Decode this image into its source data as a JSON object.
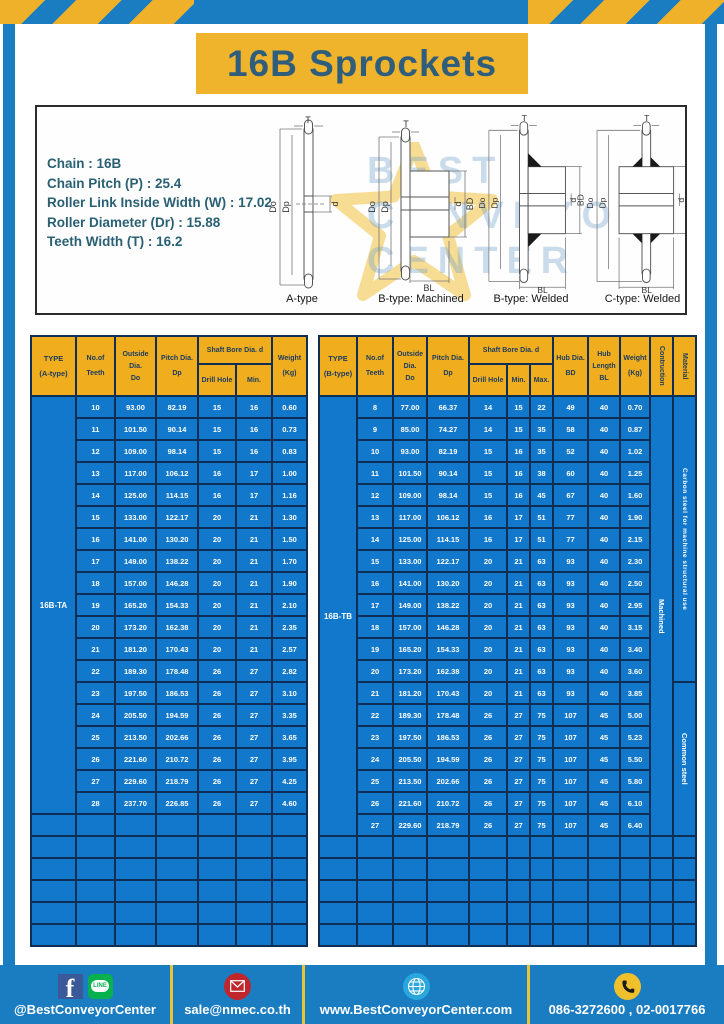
{
  "title": "16B Sprockets",
  "specs": {
    "lines": [
      "Chain  :  16B",
      "Chain Pitch (P)  :  25.4",
      "Roller Link Inside Width (W)  :  17.02",
      "Roller Diameter (Dr)  : 15.88",
      "Teeth Width (T)  :  16.2"
    ]
  },
  "diagrams": {
    "captions": [
      "A-type",
      "B-type: Machined",
      "B-type: Welded",
      "C-type: Welded"
    ],
    "dims": {
      "T": "T",
      "Do": "Do",
      "Dp": "Dp",
      "d": "d",
      "BD": "BD",
      "BL": "BL"
    },
    "watermark": [
      "BEST",
      "CONVEYOR",
      "CENTER"
    ]
  },
  "table_a": {
    "headers": {
      "type1": "TYPE",
      "type2": "(A-type)",
      "teeth1": "No.of",
      "teeth2": "Teeth",
      "outside1": "Outside",
      "outside2": "Dia.",
      "outside3": "Do",
      "pitch1": "Pitch Dia.",
      "pitch2": "Dp",
      "shaft": "Shaft Bore Dia. d",
      "drill": "Drill Hole",
      "min": "Min.",
      "weight1": "Weight",
      "weight2": "(Kg)"
    },
    "type_value": "16B-TA",
    "rows": [
      [
        "10",
        "93.00",
        "82.19",
        "15",
        "16",
        "0.60"
      ],
      [
        "11",
        "101.50",
        "90.14",
        "15",
        "16",
        "0.73"
      ],
      [
        "12",
        "109.00",
        "98.14",
        "15",
        "16",
        "0.83"
      ],
      [
        "13",
        "117.00",
        "106.12",
        "16",
        "17",
        "1.00"
      ],
      [
        "14",
        "125.00",
        "114.15",
        "16",
        "17",
        "1.16"
      ],
      [
        "15",
        "133.00",
        "122.17",
        "20",
        "21",
        "1.30"
      ],
      [
        "16",
        "141.00",
        "130.20",
        "20",
        "21",
        "1.50"
      ],
      [
        "17",
        "149.00",
        "138.22",
        "20",
        "21",
        "1.70"
      ],
      [
        "18",
        "157.00",
        "146.28",
        "20",
        "21",
        "1.90"
      ],
      [
        "19",
        "165.20",
        "154.33",
        "20",
        "21",
        "2.10"
      ],
      [
        "20",
        "173.20",
        "162.38",
        "20",
        "21",
        "2.35"
      ],
      [
        "21",
        "181.20",
        "170.43",
        "20",
        "21",
        "2.57"
      ],
      [
        "22",
        "189.30",
        "178.48",
        "26",
        "27",
        "2.82"
      ],
      [
        "23",
        "197.50",
        "186.53",
        "26",
        "27",
        "3.10"
      ],
      [
        "24",
        "205.50",
        "194.59",
        "26",
        "27",
        "3.35"
      ],
      [
        "25",
        "213.50",
        "202.66",
        "26",
        "27",
        "3.65"
      ],
      [
        "26",
        "221.60",
        "210.72",
        "26",
        "27",
        "3.95"
      ],
      [
        "27",
        "229.60",
        "218.79",
        "26",
        "27",
        "4.25"
      ],
      [
        "28",
        "237.70",
        "226.85",
        "26",
        "27",
        "4.60"
      ]
    ],
    "empty_rows": 6
  },
  "table_b": {
    "headers": {
      "type1": "TYPE",
      "type2": "(B-type)",
      "teeth1": "No.of",
      "teeth2": "Teeth",
      "outside1": "Outside",
      "outside2": "Dia.",
      "outside3": "Do",
      "pitch1": "Pitch Dia.",
      "pitch2": "Dp",
      "shaft": "Shaft Bore Dia. d",
      "drill": "Drill Hole",
      "min": "Min.",
      "max": "Max.",
      "hub1": "Hub Dia.",
      "hub2": "BD",
      "hublen1": "Hub",
      "hublen2": "Length",
      "hublen3": "BL",
      "weight1": "Weight",
      "weight2": "(Kg)",
      "construction": "Contruction",
      "material": "Material"
    },
    "type_value": "16B-TB",
    "construction_value": "Machined",
    "materials": [
      "Carbon steel for machine structural use",
      "Common steel"
    ],
    "rows": [
      [
        "8",
        "77.00",
        "66.37",
        "14",
        "15",
        "22",
        "49",
        "40",
        "0.70"
      ],
      [
        "9",
        "85.00",
        "74.27",
        "14",
        "15",
        "35",
        "58",
        "40",
        "0.87"
      ],
      [
        "10",
        "93.00",
        "82.19",
        "15",
        "16",
        "35",
        "52",
        "40",
        "1.02"
      ],
      [
        "11",
        "101.50",
        "90.14",
        "15",
        "16",
        "38",
        "60",
        "40",
        "1.25"
      ],
      [
        "12",
        "109.00",
        "98.14",
        "15",
        "16",
        "45",
        "67",
        "40",
        "1.60"
      ],
      [
        "13",
        "117.00",
        "106.12",
        "16",
        "17",
        "51",
        "77",
        "40",
        "1.90"
      ],
      [
        "14",
        "125.00",
        "114.15",
        "16",
        "17",
        "51",
        "77",
        "40",
        "2.15"
      ],
      [
        "15",
        "133.00",
        "122.17",
        "20",
        "21",
        "63",
        "93",
        "40",
        "2.30"
      ],
      [
        "16",
        "141.00",
        "130.20",
        "20",
        "21",
        "63",
        "93",
        "40",
        "2.50"
      ],
      [
        "17",
        "149.00",
        "138.22",
        "20",
        "21",
        "63",
        "93",
        "40",
        "2.95"
      ],
      [
        "18",
        "157.00",
        "146.28",
        "20",
        "21",
        "63",
        "93",
        "40",
        "3.15"
      ],
      [
        "19",
        "165.20",
        "154.33",
        "20",
        "21",
        "63",
        "93",
        "40",
        "3.40"
      ],
      [
        "20",
        "173.20",
        "162.38",
        "20",
        "21",
        "63",
        "93",
        "40",
        "3.60"
      ],
      [
        "21",
        "181.20",
        "170.43",
        "20",
        "21",
        "63",
        "93",
        "40",
        "3.85"
      ],
      [
        "22",
        "189.30",
        "178.48",
        "26",
        "27",
        "75",
        "107",
        "45",
        "5.00"
      ],
      [
        "23",
        "197.50",
        "186.53",
        "26",
        "27",
        "75",
        "107",
        "45",
        "5.23"
      ],
      [
        "24",
        "205.50",
        "194.59",
        "26",
        "27",
        "75",
        "107",
        "45",
        "5.50"
      ],
      [
        "25",
        "213.50",
        "202.66",
        "26",
        "27",
        "75",
        "107",
        "45",
        "5.80"
      ],
      [
        "26",
        "221.60",
        "210.72",
        "26",
        "27",
        "75",
        "107",
        "45",
        "6.10"
      ],
      [
        "27",
        "229.60",
        "218.79",
        "26",
        "27",
        "75",
        "107",
        "45",
        "6.40"
      ]
    ],
    "empty_rows": 5
  },
  "footer": {
    "social": "@BestConveyorCenter",
    "line_badge": "LINE",
    "fb_glyph": "f",
    "email": "sale@nmec.co.th",
    "website": "www.BestConveyorCenter.com",
    "phones": "086-3272600 , 02-0017766"
  }
}
